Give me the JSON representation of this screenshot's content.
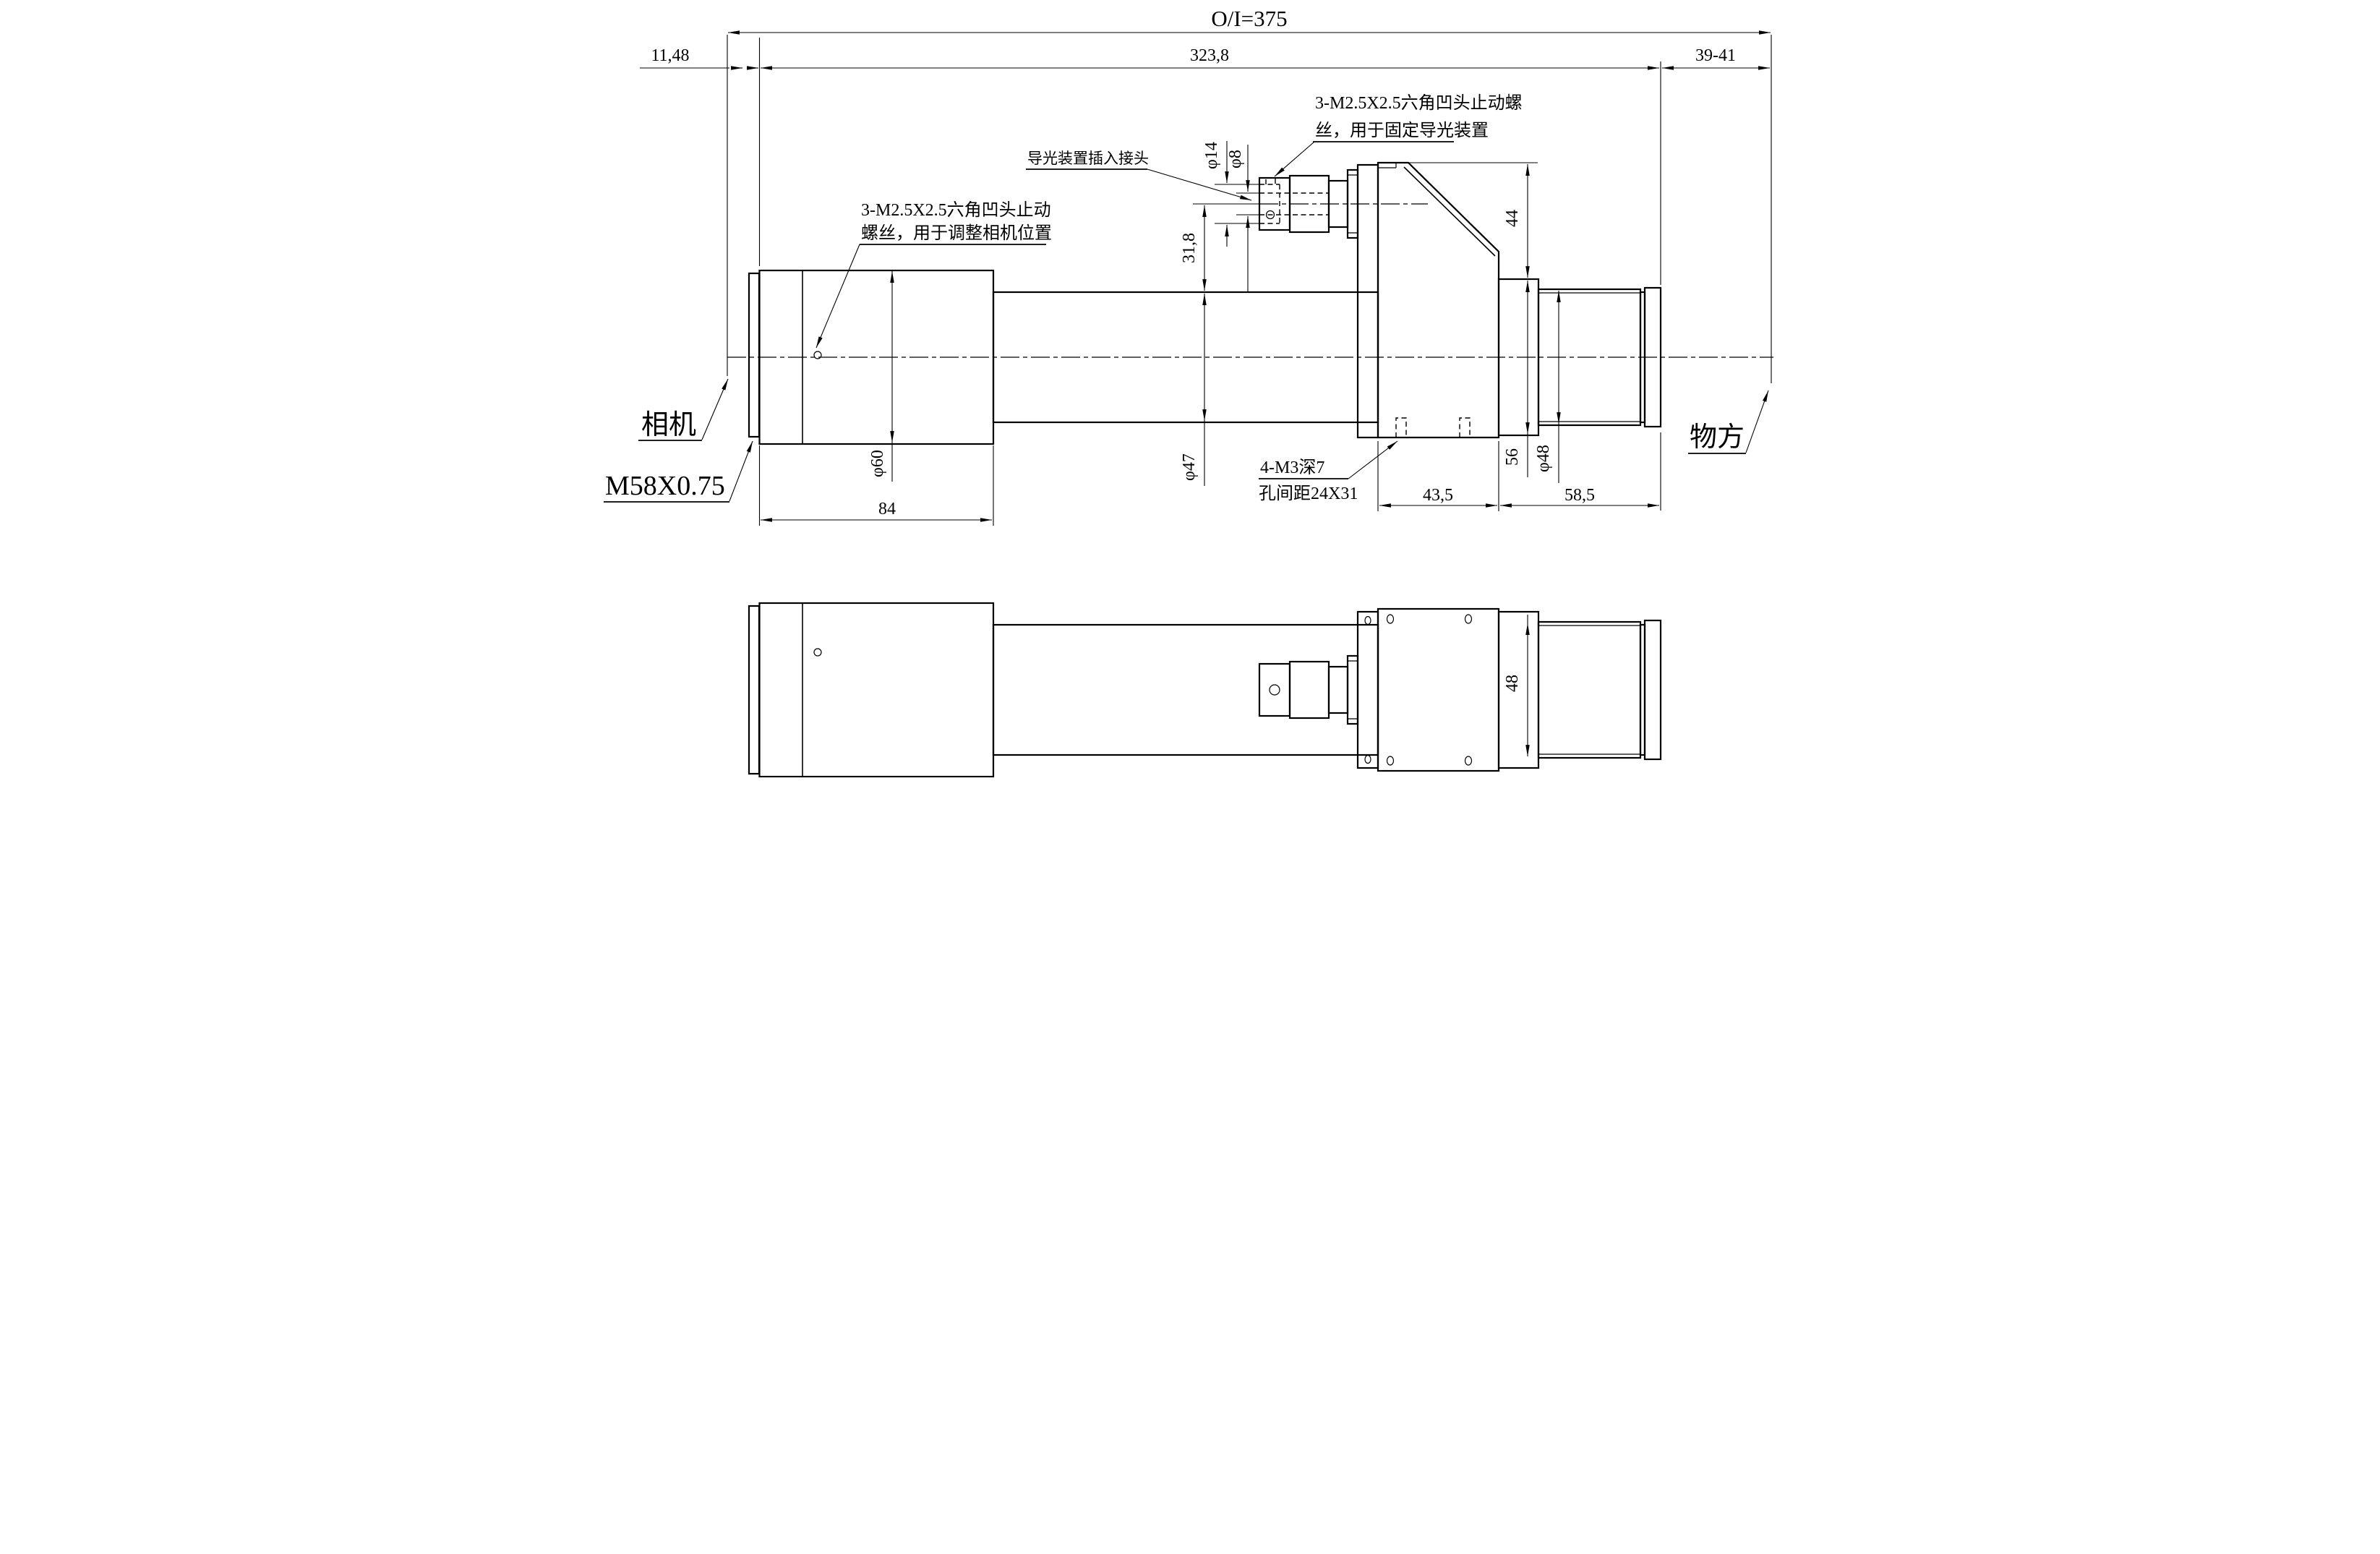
{
  "drawing": {
    "dims": {
      "oi": "O/I=375",
      "left_offset": "11,48",
      "tube_length": "323,8",
      "working_dist": "39-41",
      "phi14": "φ14",
      "phi8": "φ8",
      "guide_height": "31,8",
      "block_top": "44",
      "phi60": "φ60",
      "body_length": "84",
      "phi47": "φ47",
      "flange_sq": "56",
      "phi48": "φ48",
      "block_length": "43,5",
      "front_length": "58,5",
      "bottom_width": "48"
    },
    "annotations": {
      "guide_screw_line1": "3-M2.5X2.5六角凹头止动螺",
      "guide_screw_line2": "丝，用于固定导光装置",
      "camera_screw_line1": "3-M2.5X2.5六角凹头止动",
      "camera_screw_line2": "螺丝，用于调整相机位置",
      "light_guide_port": "导光装置插入接头",
      "holes_line1": "4-M3深7",
      "holes_line2": "孔间距24X31",
      "camera_label": "相机",
      "thread_label": "M58X0.75",
      "object_side_label": "物方"
    }
  }
}
